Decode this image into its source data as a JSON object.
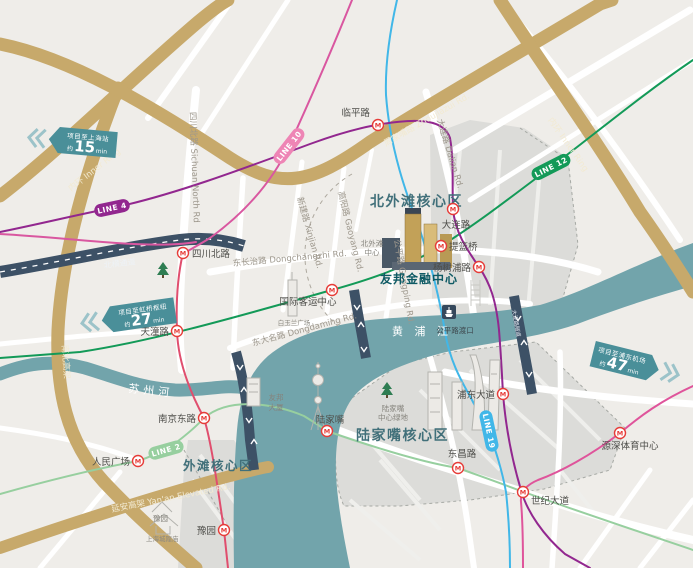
{
  "map": {
    "areas": {
      "north_bund": "北外滩核心区",
      "lujiazui": "陆家嘴核心区",
      "bund": "外滩核心区"
    },
    "rivers": {
      "huangpu": "黄 浦 江",
      "suzhou": "苏州河"
    },
    "project": {
      "name": "友邦金融中心"
    },
    "badges": [
      {
        "title": "项目至上海站",
        "prefix": "约",
        "minutes": "15",
        "unit": "min"
      },
      {
        "title": "项目至虹桥枢纽",
        "prefix": "约",
        "minutes": "27",
        "unit": "min"
      },
      {
        "title": "项目至浦东机场",
        "prefix": "约",
        "minutes": "47",
        "unit": "min"
      }
    ],
    "metro_lines": [
      {
        "id": "4",
        "label": "LINE 4",
        "color": "#92278f"
      },
      {
        "id": "10",
        "label": "LINE 10",
        "color": "#ee85b5"
      },
      {
        "id": "12",
        "label": "LINE 12",
        "color": "#139a58"
      },
      {
        "id": "2",
        "label": "LINE 2",
        "color": "#97cf9f"
      },
      {
        "id": "19",
        "label": "LINE 19",
        "color": "#41b7e8"
      }
    ],
    "line_stroke_colors": {
      "line4": "#92278f",
      "line10": "#d957a0",
      "line10_south": "#e04e6e",
      "line12": "#139a58",
      "line2": "#97cf9f",
      "line19": "#41b7e8",
      "line6": "#df549b"
    },
    "stations": [
      {
        "name": "四川北路"
      },
      {
        "name": "临平路"
      },
      {
        "name": "大连路"
      },
      {
        "name": "提篮桥"
      },
      {
        "name": "杨树浦路"
      },
      {
        "name": "国际客运中心"
      },
      {
        "name": "天潼路"
      },
      {
        "name": "南京东路"
      },
      {
        "name": "人民广场"
      },
      {
        "name": "豫园"
      },
      {
        "name": "陆家嘴"
      },
      {
        "name": "东昌路"
      },
      {
        "name": "世纪大道"
      },
      {
        "name": "浦东大道"
      },
      {
        "name": "源深体育中心"
      }
    ],
    "road_labels": [
      "内环 Inner Ring",
      "内环 Inner Ring",
      "周家嘴路 Zhoujiazui Rd.",
      "四川北路 Sichuan North Rd",
      "大连路 Dalian Rd.",
      "东长治路 Dongchangzhi Rd.",
      "东大名路 Dongdaming Rd.",
      "新建路 Xinjian Rd.",
      "高阳路 Gaoyang Rd.",
      "公平路 Gongping Rd.",
      "北横通道",
      "南北高架",
      "延安高架 Yan'an Elevated Rd.",
      "大连路隧道"
    ],
    "landmarks": {
      "north_bund_center": {
        "l1": "北外滩",
        "l2": "中心"
      },
      "aia_tower": {
        "l1": "友邦",
        "l2": "大厦"
      },
      "magnolia_plaza": "白玉兰广场",
      "gongping_ferry": "公平路渡口",
      "lujiazui_green": {
        "l1": "陆家嘴",
        "l2": "中心绿地"
      },
      "yuyuan": "豫园",
      "city_god_temple": "上海城隍庙"
    },
    "icons": {
      "metro": "M"
    },
    "colors": {
      "land": "#efede9",
      "district_gray": "#dcdcd9",
      "river": "#72a4ab",
      "gold_road": "#c7a96b",
      "navy_road": "#3d5166",
      "badge_teal": "#4a8f99",
      "metro_red": "#e63c38",
      "area_text": "#41707a"
    }
  }
}
